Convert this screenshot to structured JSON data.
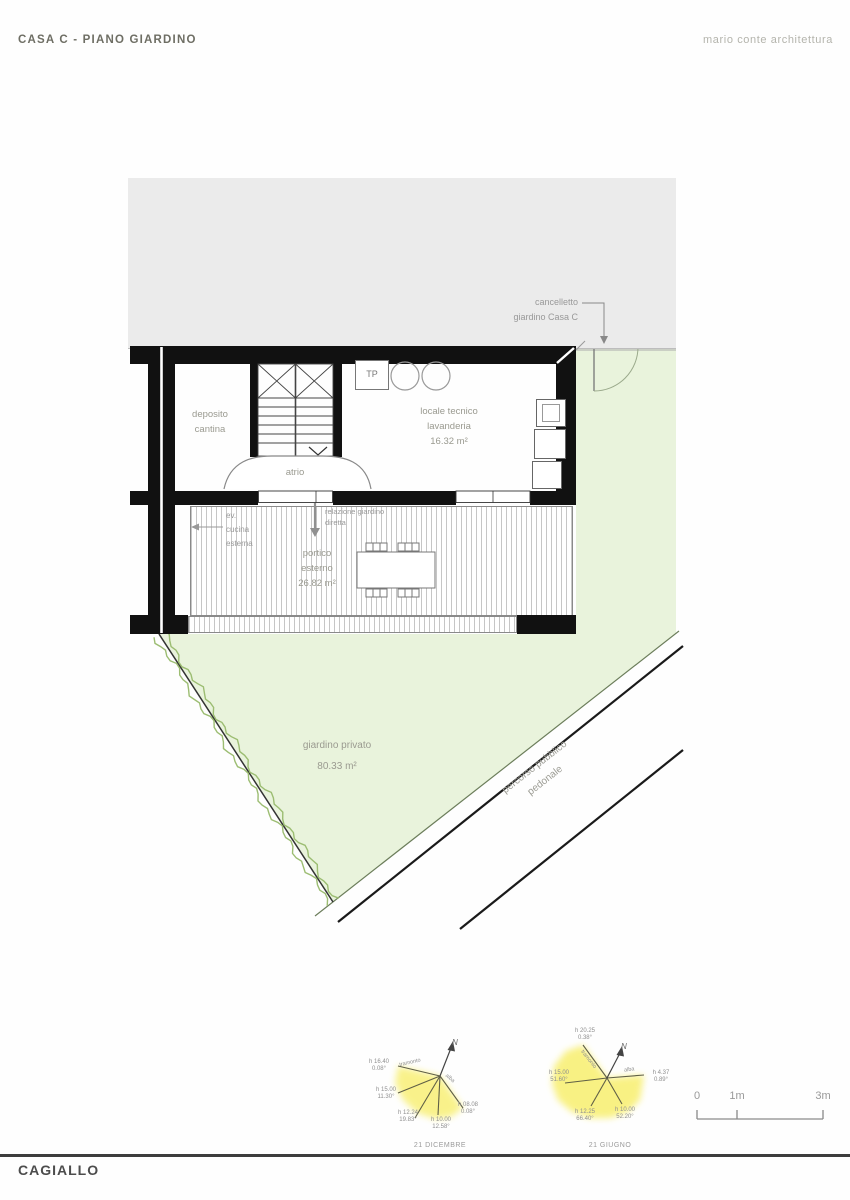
{
  "header": {
    "title": "CASA C - PIANO GIARDINO",
    "studio": "mario conte architettura"
  },
  "plan": {
    "labels": {
      "cancelletto": "cancelletto\ngiardino Casa C",
      "deposito": "deposito\ncantina",
      "locale_tecnico": "locale tecnico\nlavanderia\n16.32 m²",
      "tp": "TP",
      "atrio": "atrio",
      "ev_cucina": "ev.\ncucina\nesterna",
      "relazione": "relazione giardino\ndiretta",
      "portico": "portico\nesterno\n26.82 m²",
      "giardino": "giardino privato\n80.33 m²",
      "percorso": "percorso pubblico\npedonale"
    }
  },
  "sun_diagrams": [
    {
      "caption": "21 DICEMBRE",
      "north": "N",
      "sunset_word": "tramonto",
      "sunrise_word": "alba",
      "points": [
        {
          "time": "h 16.40",
          "angle": "0.08°"
        },
        {
          "time": "h 15.00",
          "angle": "11.30°"
        },
        {
          "time": "h 12.24",
          "angle": "19.83°"
        },
        {
          "time": "h 10.00",
          "angle": "12.58°"
        },
        {
          "time": "h 08.08",
          "angle": "0.08°"
        }
      ]
    },
    {
      "caption": "21 GIUGNO",
      "north": "N",
      "sunset_word": "tramonto",
      "sunrise_word": "alba",
      "points": [
        {
          "time": "h 20.25",
          "angle": "0.38°"
        },
        {
          "time": "h 15.00",
          "angle": "51.60°"
        },
        {
          "time": "h 12.25",
          "angle": "66.40°"
        },
        {
          "time": "h 10.00",
          "angle": "52.20°"
        },
        {
          "time": "h 4.37",
          "angle": "0.89°"
        }
      ]
    }
  ],
  "scale_bar": {
    "ticks": [
      "0",
      "1m",
      "3m"
    ]
  },
  "footer": {
    "location": "CAGIALLO"
  },
  "colors": {
    "garden": "#e9f3dc",
    "building_mass": "#ebebeb",
    "sun": "#f8ef6e",
    "hedge": "#9cbd72",
    "wall": "#111111"
  }
}
